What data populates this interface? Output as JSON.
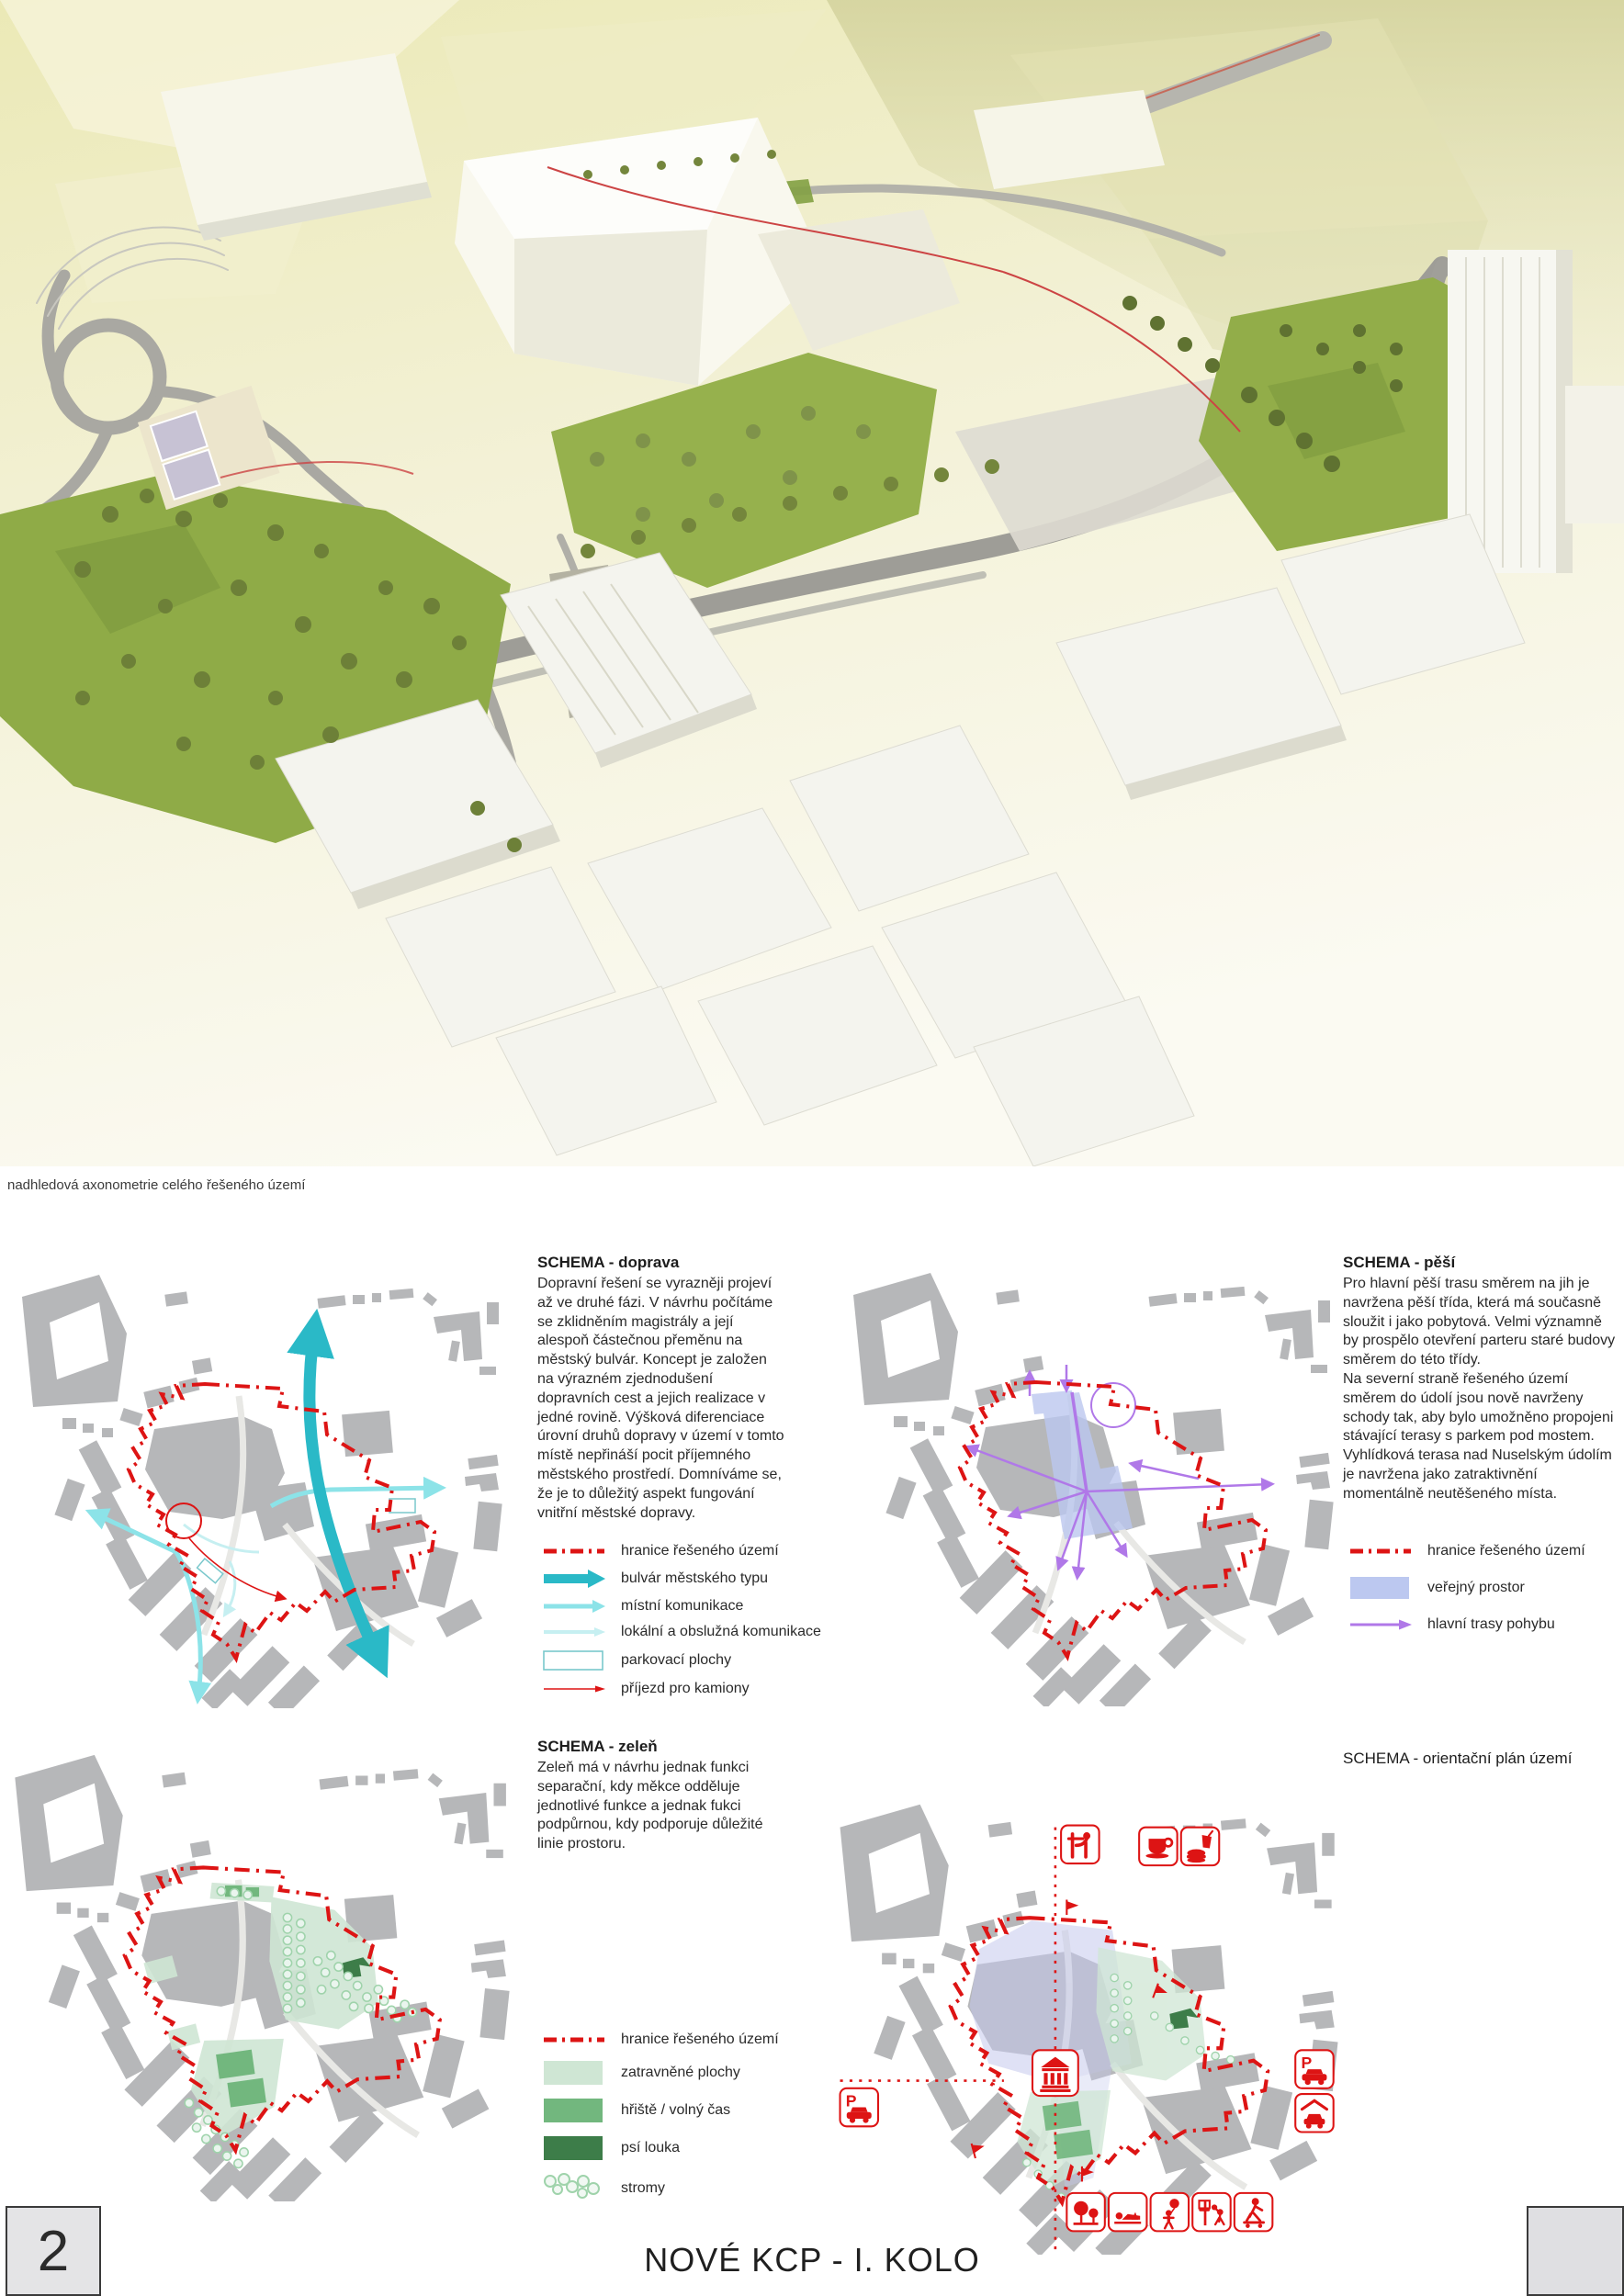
{
  "page": {
    "number": "2",
    "footer_title": "NOVÉ KCP - I. KOLO",
    "render_caption": "nadhledová axonometrie celého řešeného území"
  },
  "colors": {
    "boundary_red": "#dd1414",
    "bulvar_teal": "#2ab9c7",
    "mistni_teal": "#8ce3e8",
    "lokalni_teal": "#c6eff1",
    "verejny_prostor_blue": "#bcc8f0",
    "trasy_purple": "#b078e8",
    "zatravnene_green": "#cfe6d4",
    "hriste_green": "#72b77e",
    "psi_louka_green": "#3d7d49",
    "stromy_green": "#9fd3ab",
    "building_gray": "#b6b7b9"
  },
  "schemas": {
    "doprava": {
      "title": "SCHEMA - doprava",
      "body": "Dopravní řešení se vyrazněji projeví až ve druhé fázi. V návrhu počítáme se zklidněním magistrály a její alespoň částečnou přeměnu na městský bulvár. Koncept je založen na výrazném zjednodušení dopravních cest a jejich realizace v jedné rovině. Výšková diferenciace úrovní druhů dopravy v území v tomto místě nepřináší pocit příjemného městského prostředí. Domníváme se, že je to důležitý aspekt fungování vnitřní městské dopravy.",
      "legend": [
        {
          "label": "hranice řešeného území",
          "color": "#dd1414"
        },
        {
          "label": "bulvár městského typu",
          "color": "#2ab9c7"
        },
        {
          "label": "místní komunikace",
          "color": "#8ce3e8"
        },
        {
          "label": "lokální a obslužná komunikace",
          "color": "#c6eff1"
        },
        {
          "label": "parkovací plochy",
          "color": "#7ac8cc"
        },
        {
          "label": "příjezd pro kamiony",
          "color": "#dd1414"
        }
      ]
    },
    "pesi": {
      "title": "SCHEMA - pěší",
      "body1": "Pro hlavní pěší trasu směrem na jih je navržena pěší třída, která má současně sloužit i jako pobytová.  Velmi významně by prospělo otevření parteru staré budovy směrem do této třídy.",
      "body2": "Na severní straně řešeného území směrem do údolí jsou nově navrženy schody tak, aby bylo umožněno propojeni stávající terasy s parkem pod mostem.",
      "body3": "Vyhlídková terasa nad Nuselským údolím je navržena jako zatraktivnění momentálně neutěšeného místa.",
      "legend": [
        {
          "label": "hranice řešeného území",
          "color": "#dd1414"
        },
        {
          "label": "veřejný prostor",
          "color": "#bcc8f0"
        },
        {
          "label": "hlavní trasy pohybu",
          "color": "#b078e8"
        }
      ]
    },
    "zelen": {
      "title": "SCHEMA - zeleň",
      "body": "Zeleň má v návrhu jednak funkci separační, kdy měkce odděluje jednotlivé funkce a jednak fukci podpůrnou, kdy podporuje důležité linie prostoru.",
      "legend": [
        {
          "label": "hranice řešeného území",
          "color": "#dd1414"
        },
        {
          "label": "zatravněné plochy",
          "color": "#cfe6d4"
        },
        {
          "label": "hřiště / volný čas",
          "color": "#72b77e"
        },
        {
          "label": "psí louka",
          "color": "#3d7d49"
        },
        {
          "label": "stromy",
          "color": "#9fd3ab"
        }
      ]
    },
    "orientacni": {
      "title": "SCHEMA - orientační plán území",
      "icons": [
        "viewpoint",
        "cafe",
        "fast-food",
        "museum",
        "parking",
        "parking",
        "garage",
        "park-trees",
        "relax",
        "kids-play",
        "basketball",
        "skateboard"
      ]
    }
  }
}
